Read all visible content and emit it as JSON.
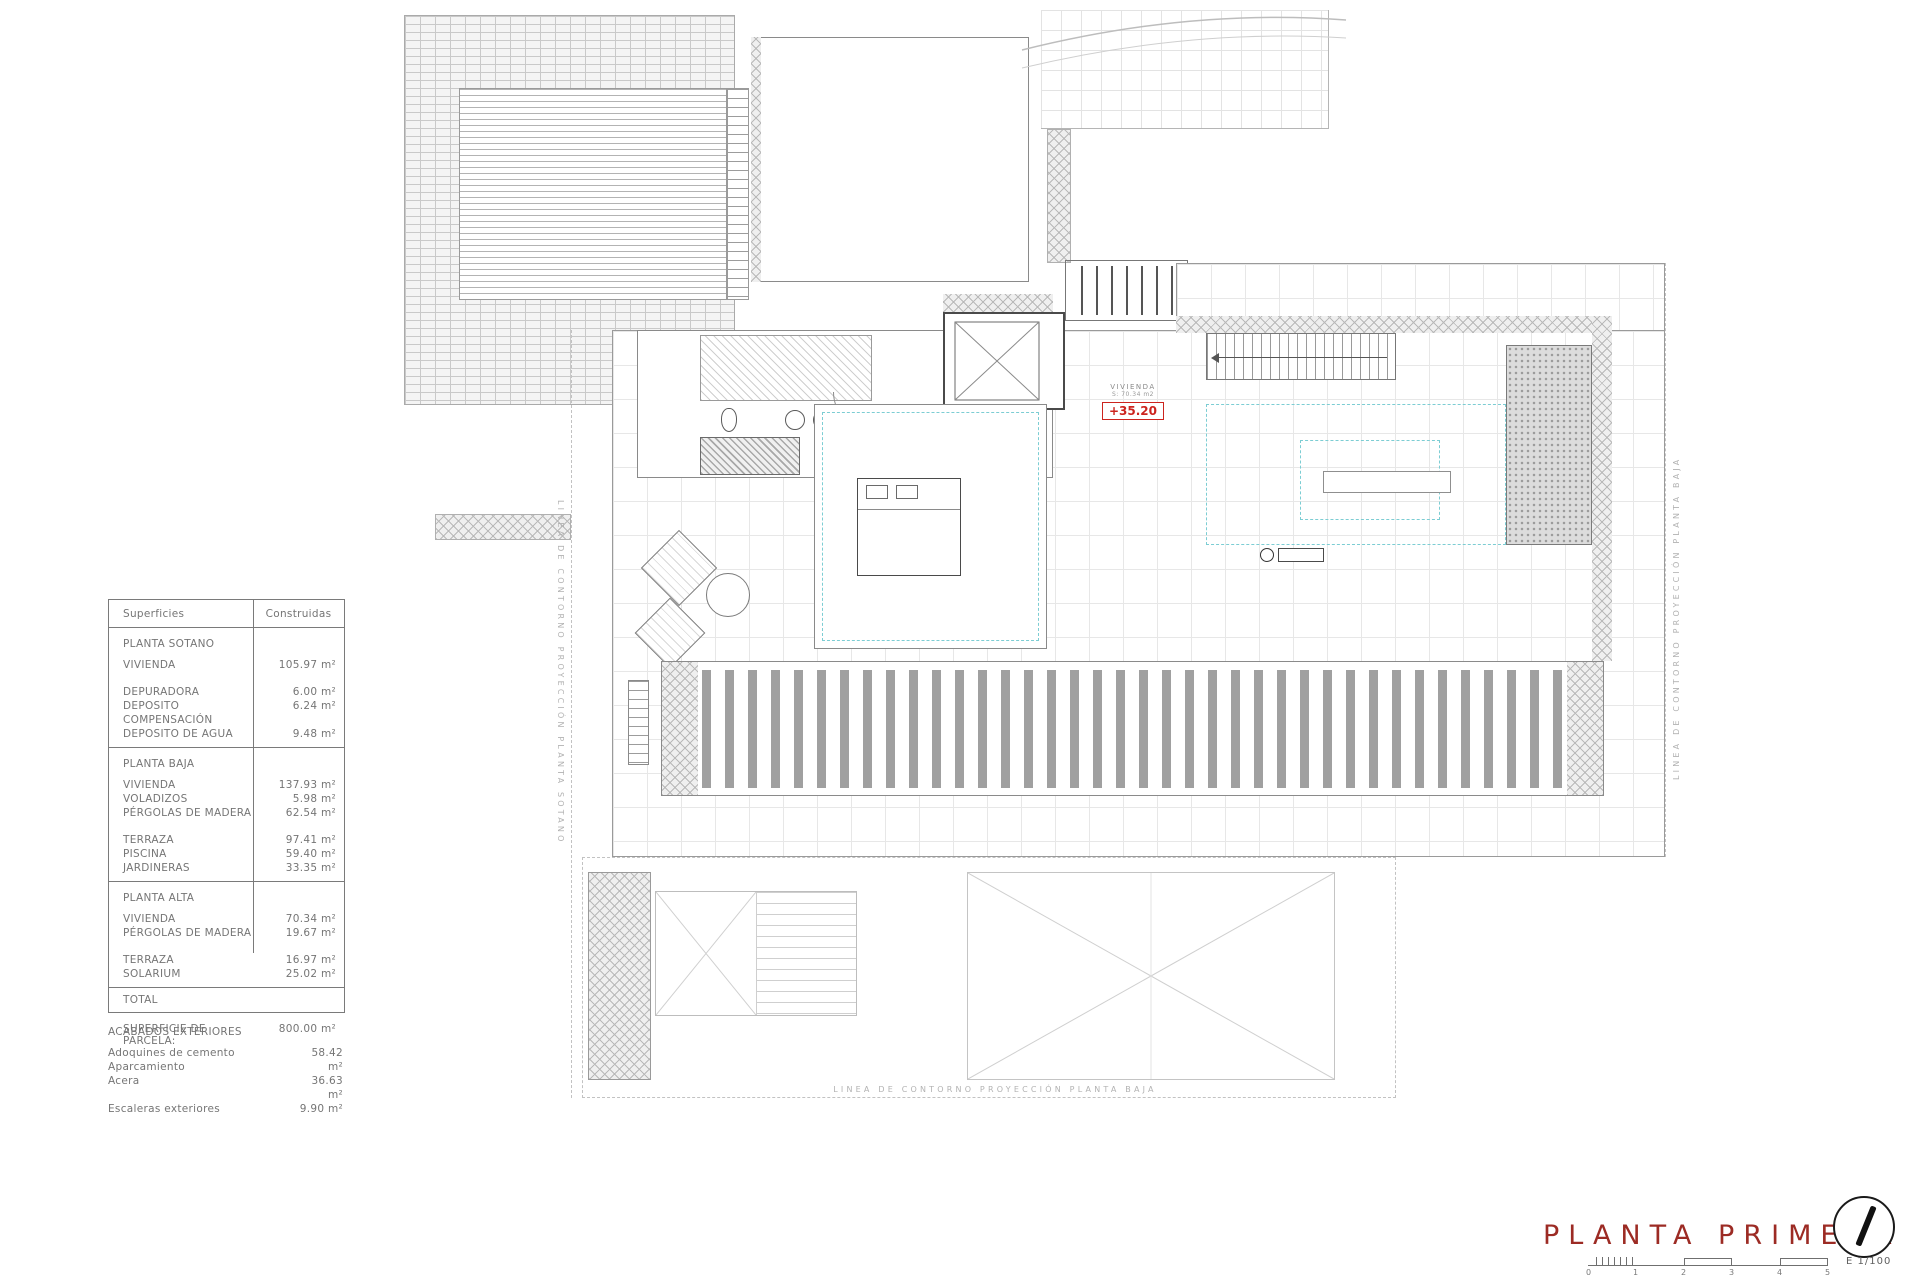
{
  "colors": {
    "title_red": "#9c2b24",
    "elevation_red": "#cc241e",
    "void_dash_cyan": "#7ccdd3",
    "drawing_gray": "#9a9a9a"
  },
  "areas_table": {
    "col_headers": {
      "left": "Superficies",
      "right": "Construidas"
    },
    "sections": [
      {
        "heading": "PLANTA SOTANO",
        "rows": [
          {
            "label": "VIVIENDA",
            "value": "105.97 m²"
          },
          {
            "label": "DEPURADORA",
            "value": "6.00 m²"
          },
          {
            "label": "DEPOSITO COMPENSACIÓN",
            "value": "6.24 m²"
          },
          {
            "label": "DEPOSITO DE AGUA",
            "value": "9.48 m²"
          }
        ]
      },
      {
        "heading": "PLANTA BAJA",
        "rows": [
          {
            "label": "VIVIENDA",
            "value": "137.93 m²"
          },
          {
            "label": "VOLADIZOS",
            "value": "5.98 m²"
          },
          {
            "label": "PÉRGOLAS DE MADERA",
            "value": "62.54 m²"
          },
          {
            "label": "TERRAZA",
            "value": "97.41 m²"
          },
          {
            "label": "PISCINA",
            "value": "59.40 m²"
          },
          {
            "label": "JARDINERAS",
            "value": "33.35 m²"
          }
        ]
      },
      {
        "heading": "PLANTA ALTA",
        "rows": [
          {
            "label": "VIVIENDA",
            "value": "70.34 m²"
          },
          {
            "label": "PÉRGOLAS DE MADERA",
            "value": "19.67 m²"
          },
          {
            "label": "TERRAZA",
            "value": "16.97 m²"
          },
          {
            "label": "SOLARIUM",
            "value": "25.02 m²"
          }
        ]
      }
    ],
    "total_label": "TOTAL",
    "parcel_label": "SUPERFICIE DE PARCELA:",
    "parcel_value": "800.00 m²"
  },
  "exterior_finishes": {
    "heading": "ACABADOS EXTERIORES",
    "rows": [
      {
        "label": "Adoquines de cemento Aparcamiento",
        "value": "58.42 m²"
      },
      {
        "label": "Acera",
        "value": "36.63 m²"
      },
      {
        "label": "Escaleras exteriores",
        "value": "9.90 m²"
      }
    ]
  },
  "plan": {
    "unit_label": "VIVIENDA",
    "unit_area": "S: 70.34 m2",
    "elevation": "+35.20",
    "contour_left_label": "LINEA DE CONTORNO PROYECCIÓN PLANTA SOTANO",
    "contour_right_label": "LINEA DE CONTORNO PROYECCIÓN PLANTA BAJA",
    "contour_bottom_label": "LINEA DE CONTORNO PROYECCIÓN PLANTA BAJA"
  },
  "title_block": {
    "title": "PLANTA PRIMERA",
    "scale_text": "E 1/100",
    "scale_ticks": [
      "0",
      "1",
      "2",
      "3",
      "4",
      "5"
    ]
  }
}
